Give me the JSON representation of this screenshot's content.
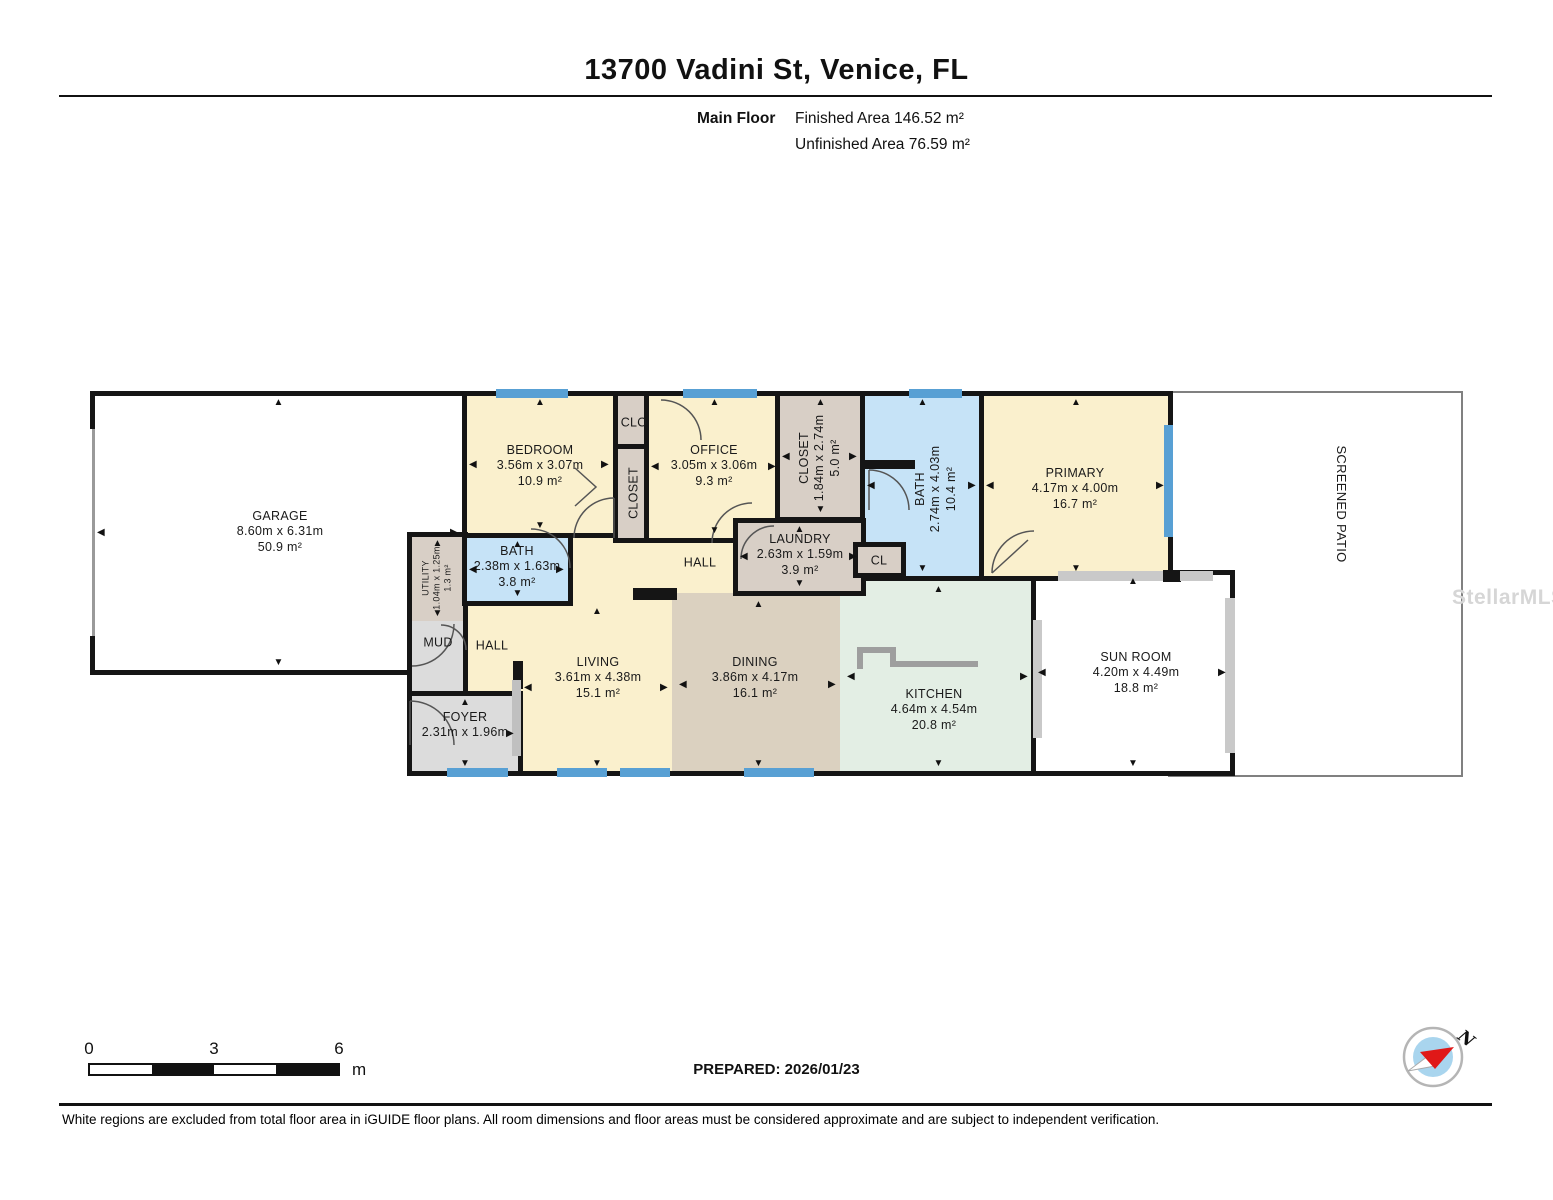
{
  "header": {
    "title": "13700 Vadini St, Venice, FL",
    "floor_label": "Main Floor",
    "finished_area": "Finished Area 146.52 m²",
    "unfinished_area": "Unfinished Area 76.59 m²"
  },
  "footer": {
    "prepared": "PREPARED: 2026/01/23",
    "disclaimer": "White regions are excluded from total floor area in iGUIDE floor plans. All room dimensions and floor areas must be considered approximate and are subject to independent verification.",
    "scale_labels": [
      "0",
      "3",
      "6"
    ],
    "scale_unit": "m",
    "compass_label": "N"
  },
  "watermark": "StellarMLS",
  "colors": {
    "wall": "#151515",
    "cream": "#faf0cd",
    "tan": "#dbd1c0",
    "beige": "#d8cfc6",
    "blue": "#c6e3f7",
    "green": "#e3eee4",
    "gray": "#dcdcdc",
    "white": "#ffffff",
    "window": "#58a0d4",
    "rail": "#c9c9c9",
    "counter": "#9e9e9e"
  },
  "rooms": [
    {
      "id": "screened-patio",
      "name": "SCREENED PATIO",
      "x": 1168,
      "y": 391,
      "w": 295,
      "h": 386,
      "fill": "white",
      "wall": 2,
      "wallColor": "#808080",
      "lx": 1341,
      "ly": 504,
      "rot": 90,
      "fs": 13
    },
    {
      "id": "garage",
      "name": "GARAGE",
      "dim": "8.60m x 6.31m",
      "area": "50.9 m²",
      "x": 90,
      "y": 391,
      "w": 377,
      "h": 284,
      "fill": "white",
      "lx": 280,
      "ly": 532,
      "arrows": "trbl"
    },
    {
      "id": "hall-upper",
      "name": "HALL",
      "x": 567,
      "y": 538,
      "w": 172,
      "h": 62,
      "fill": "cream",
      "open": "trbl",
      "lx": 700,
      "ly": 563
    },
    {
      "id": "hall-lower",
      "name": "HALL",
      "x": 464,
      "y": 600,
      "w": 58,
      "h": 95,
      "fill": "cream",
      "open": "trbl",
      "lx": 492,
      "ly": 646
    },
    {
      "id": "living",
      "name": "LIVING",
      "dim": "3.61m x 4.38m",
      "area": "15.1 m²",
      "x": 517,
      "y": 600,
      "w": 160,
      "h": 176,
      "fill": "cream",
      "open": "trl",
      "lx": 598,
      "ly": 678,
      "arrows": "trbl"
    },
    {
      "id": "dining",
      "name": "DINING",
      "dim": "3.86m x 4.17m",
      "area": "16.1 m²",
      "x": 672,
      "y": 593,
      "w": 173,
      "h": 183,
      "fill": "tan",
      "open": "tlr",
      "lx": 755,
      "ly": 678,
      "arrows": "trbl"
    },
    {
      "id": "kitchen",
      "name": "KITCHEN",
      "dim": "4.64m x 4.54m",
      "area": "20.8 m²",
      "x": 840,
      "y": 578,
      "w": 197,
      "h": 198,
      "fill": "green",
      "open": "tl",
      "lx": 934,
      "ly": 710,
      "arrows": "trbl"
    },
    {
      "id": "sunroom",
      "name": "SUN ROOM",
      "dim": "4.20m x 4.49m",
      "area": "18.8 m²",
      "x": 1031,
      "y": 570,
      "w": 204,
      "h": 206,
      "fill": "white",
      "lx": 1136,
      "ly": 673,
      "arrows": "trbl"
    },
    {
      "id": "bedroom",
      "name": "BEDROOM",
      "dim": "3.56m x 3.07m",
      "area": "10.9 m²",
      "x": 462,
      "y": 391,
      "w": 156,
      "h": 147,
      "fill": "cream",
      "lx": 540,
      "ly": 466,
      "arrows": "trbl"
    },
    {
      "id": "clo",
      "name": "CLO",
      "x": 613,
      "y": 391,
      "w": 44,
      "h": 58,
      "fill": "beige",
      "lx": 634,
      "ly": 423
    },
    {
      "id": "closet-hall",
      "name": "CLOSET",
      "x": 613,
      "y": 444,
      "w": 44,
      "h": 99,
      "fill": "beige",
      "rot": -90,
      "lx": 634,
      "ly": 493
    },
    {
      "id": "office",
      "name": "OFFICE",
      "dim": "3.05m x 3.06m",
      "area": "9.3 m²",
      "x": 644,
      "y": 391,
      "w": 141,
      "h": 152,
      "fill": "cream",
      "lx": 714,
      "ly": 466,
      "arrows": "trbl"
    },
    {
      "id": "closet-primary",
      "name": "CLOSET",
      "dim": "1.84m x 2.74m",
      "area": "5.0 m²",
      "x": 775,
      "y": 391,
      "w": 91,
      "h": 131,
      "fill": "beige",
      "rot": -90,
      "lx": 820,
      "ly": 458,
      "arrows": "trbl"
    },
    {
      "id": "bath-main",
      "name": "BATH",
      "dim": "2.74m x 4.03m",
      "area": "10.4 m²",
      "x": 860,
      "y": 391,
      "w": 125,
      "h": 190,
      "fill": "blue",
      "rot": -90,
      "lx": 936,
      "ly": 489,
      "arrows": "trbl"
    },
    {
      "id": "primary",
      "name": "PRIMARY",
      "dim": "4.17m x 4.00m",
      "area": "16.7 m²",
      "x": 979,
      "y": 391,
      "w": 194,
      "h": 190,
      "fill": "cream",
      "lx": 1075,
      "ly": 489,
      "arrows": "trbl"
    },
    {
      "id": "laundry",
      "name": "LAUNDRY",
      "dim": "2.63m x 1.59m",
      "area": "3.9 m²",
      "x": 733,
      "y": 518,
      "w": 133,
      "h": 78,
      "fill": "beige",
      "lx": 800,
      "ly": 555,
      "arrows": "trbl"
    },
    {
      "id": "utility",
      "name": "UTILITY",
      "dim": "1.04m x 1.25m",
      "area": "1.3 m²",
      "x": 407,
      "y": 532,
      "w": 61,
      "h": 94,
      "fill": "beige",
      "rot": -90,
      "lx": 437,
      "ly": 578,
      "fs": 9,
      "arrows": "tb"
    },
    {
      "id": "bath-hall",
      "name": "BATH",
      "dim": "2.38m x 1.63m",
      "area": "3.8 m²",
      "x": 462,
      "y": 533,
      "w": 111,
      "h": 73,
      "fill": "blue",
      "lx": 517,
      "ly": 567,
      "arrows": "trbl"
    },
    {
      "id": "mud",
      "name": "MUD",
      "x": 407,
      "y": 621,
      "w": 61,
      "h": 75,
      "fill": "gray",
      "open": "t",
      "lx": 438,
      "ly": 643
    },
    {
      "id": "cl",
      "name": "CL",
      "x": 853,
      "y": 542,
      "w": 53,
      "h": 36,
      "fill": "beige",
      "lx": 879,
      "ly": 561
    },
    {
      "id": "foyer",
      "name": "FOYER",
      "dim": "2.31m x 1.96m",
      "x": 407,
      "y": 691,
      "w": 116,
      "h": 85,
      "fill": "gray",
      "lx": 465,
      "ly": 725,
      "arrows": "trb"
    }
  ],
  "windows": [
    {
      "x": 496,
      "y": 389,
      "w": 72,
      "h": 9
    },
    {
      "x": 683,
      "y": 389,
      "w": 74,
      "h": 9
    },
    {
      "x": 909,
      "y": 389,
      "w": 53,
      "h": 9
    },
    {
      "x": 1164,
      "y": 425,
      "w": 9,
      "h": 112
    },
    {
      "x": 447,
      "y": 768,
      "w": 61,
      "h": 9
    },
    {
      "x": 557,
      "y": 768,
      "w": 50,
      "h": 9
    },
    {
      "x": 620,
      "y": 768,
      "w": 50,
      "h": 9
    },
    {
      "x": 744,
      "y": 768,
      "w": 70,
      "h": 9
    }
  ],
  "walls": [
    {
      "x": 633,
      "y": 588,
      "w": 44,
      "h": 12
    },
    {
      "x": 513,
      "y": 661,
      "w": 10,
      "h": 28
    },
    {
      "x": 860,
      "y": 460,
      "w": 55,
      "h": 9
    },
    {
      "x": 1163,
      "y": 570,
      "w": 18,
      "h": 12
    }
  ],
  "overlays": [
    {
      "x": 88,
      "y": 429,
      "w": 11,
      "h": 207,
      "fill": "#ffffff"
    },
    {
      "x": 92,
      "y": 429,
      "w": 3,
      "h": 207,
      "fill": "#9a9a9a"
    },
    {
      "x": 1058,
      "y": 571,
      "w": 105,
      "h": 10,
      "fill": "#c9c9c9"
    },
    {
      "x": 1180,
      "y": 571,
      "w": 33,
      "h": 10,
      "fill": "#c9c9c9"
    },
    {
      "x": 1225,
      "y": 598,
      "w": 10,
      "h": 155,
      "fill": "#c9c9c9"
    },
    {
      "x": 1033,
      "y": 620,
      "w": 9,
      "h": 118,
      "fill": "#c9c9c9"
    },
    {
      "x": 512,
      "y": 680,
      "w": 9,
      "h": 76,
      "fill": "#c0c0c0"
    }
  ],
  "counter": [
    {
      "x": 857,
      "y": 647,
      "w": 38,
      "h": 6
    },
    {
      "x": 857,
      "y": 647,
      "w": 6,
      "h": 22
    },
    {
      "x": 890,
      "y": 647,
      "w": 6,
      "h": 20
    },
    {
      "x": 890,
      "y": 661,
      "w": 88,
      "h": 6
    }
  ]
}
